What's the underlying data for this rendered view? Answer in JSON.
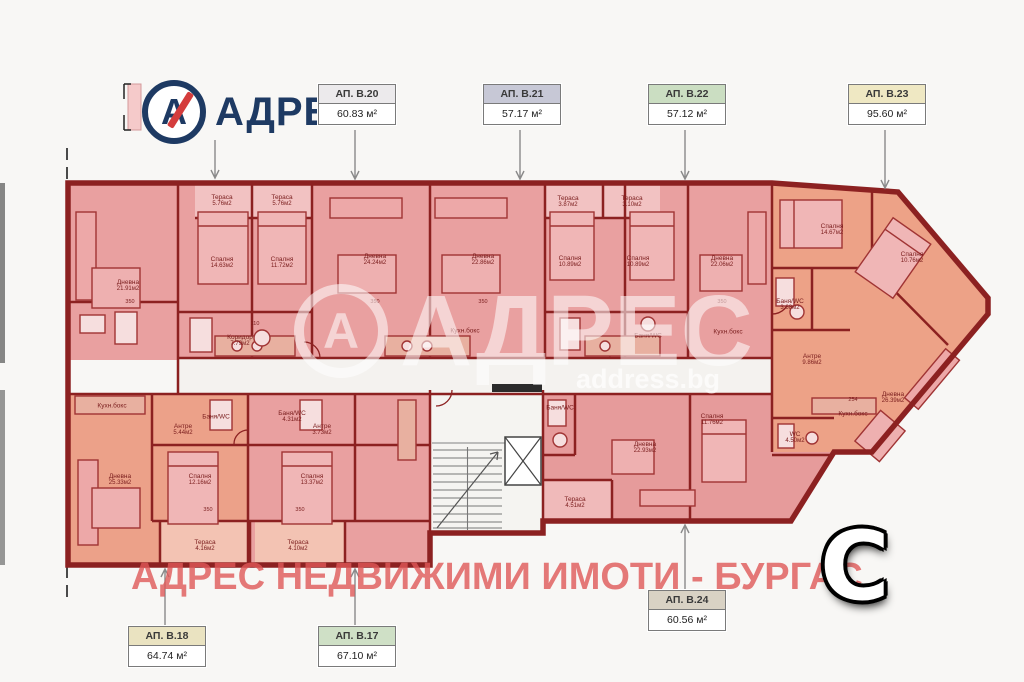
{
  "logo": {
    "mark": "А",
    "text": "АДРЕС"
  },
  "apartments": [
    {
      "id": "ap-b20",
      "name": "АП. В.20",
      "area": "60.83 м²",
      "header_color": "#eceaec"
    },
    {
      "id": "ap-b21",
      "name": "АП. В.21",
      "area": "57.17 м²",
      "header_color": "#c7c8d6"
    },
    {
      "id": "ap-b22",
      "name": "АП. В.22",
      "area": "57.12 м²",
      "header_color": "#cbdec2"
    },
    {
      "id": "ap-b23",
      "name": "АП. В.23",
      "area": "95.60 м²",
      "header_color": "#efe8c3"
    },
    {
      "id": "ap-b18",
      "name": "АП. В.18",
      "area": "64.74 м²",
      "header_color": "#eae3c1"
    },
    {
      "id": "ap-b17",
      "name": "АП. В.17",
      "area": "67.10 м²",
      "header_color": "#cfe0c6"
    },
    {
      "id": "ap-b24",
      "name": "АП. В.24",
      "area": "60.56 м²",
      "header_color": "#d9d2c4"
    }
  ],
  "rooms": [
    {
      "name": "Дневна",
      "area": "21.91м2"
    },
    {
      "name": "Спалня",
      "area": "14.63м2"
    },
    {
      "name": "Спалня",
      "area": "11.72м2"
    },
    {
      "name": "Тераса",
      "area": "5.76м2"
    },
    {
      "name": "Тераса",
      "area": "5.76м2"
    },
    {
      "name": "Коридор",
      "area": "7.79м2"
    },
    {
      "name": "Дневна",
      "area": "24.24м2"
    },
    {
      "name": "Дневна",
      "area": "22.86м2"
    },
    {
      "name": "Кухн.бокс",
      "area": ""
    },
    {
      "name": "Тераса",
      "area": "3.87м2"
    },
    {
      "name": "Тераса",
      "area": "3.10м2"
    },
    {
      "name": "Спалня",
      "area": "10.89м2"
    },
    {
      "name": "Спалня",
      "area": "10.89м2"
    },
    {
      "name": "Дневна",
      "area": "22.06м2"
    },
    {
      "name": "Баня/WC",
      "area": ""
    },
    {
      "name": "Кухн.бокс",
      "area": ""
    },
    {
      "name": "Спалня",
      "area": "14.67м2"
    },
    {
      "name": "Спалня",
      "area": "10.76м2"
    },
    {
      "name": "Баня/WC",
      "area": "3.68м2"
    },
    {
      "name": "Антре",
      "area": "9.86м2"
    },
    {
      "name": "Дневна",
      "area": "26.39м2"
    },
    {
      "name": "Кухн.бокс",
      "area": ""
    },
    {
      "name": "WC",
      "area": "4.50м2"
    },
    {
      "name": "Спалня",
      "area": "11.76м2"
    },
    {
      "name": "Дневна",
      "area": "22.93м2"
    },
    {
      "name": "Тераса",
      "area": "4.51м2"
    },
    {
      "name": "Баня/WC",
      "area": ""
    },
    {
      "name": "Кухн.бокс",
      "area": ""
    },
    {
      "name": "Антре",
      "area": "5.44м2"
    },
    {
      "name": "Дневна",
      "area": "25.33м2"
    },
    {
      "name": "Спалня",
      "area": "12.16м2"
    },
    {
      "name": "Спалня",
      "area": "13.37м2"
    },
    {
      "name": "Тераса",
      "area": "4.16м2"
    },
    {
      "name": "Тераса",
      "area": "4.10м2"
    },
    {
      "name": "Баня/WC",
      "area": ""
    },
    {
      "name": "Баня/WC",
      "area": "4.31м2"
    },
    {
      "name": "Антре",
      "area": "3.73м2"
    }
  ],
  "dimensions": [
    "350",
    "350",
    "350",
    "350",
    "350",
    "350",
    "110",
    "254"
  ],
  "watermark_center": {
    "mark": "А",
    "text": "АДРЕС",
    "site": "address.bg"
  },
  "watermark_bottom": "АДРЕС НЕДВИЖИМИ ИМОТИ - БУРГАС",
  "compass": "C",
  "colors": {
    "brand_navy": "#1e3a63",
    "brand_red": "#d43c3c",
    "wall": "#8c2121",
    "room_pink": "#e9a0a0",
    "room_orange": "#eda287",
    "watermark_pink": "#df5858"
  }
}
